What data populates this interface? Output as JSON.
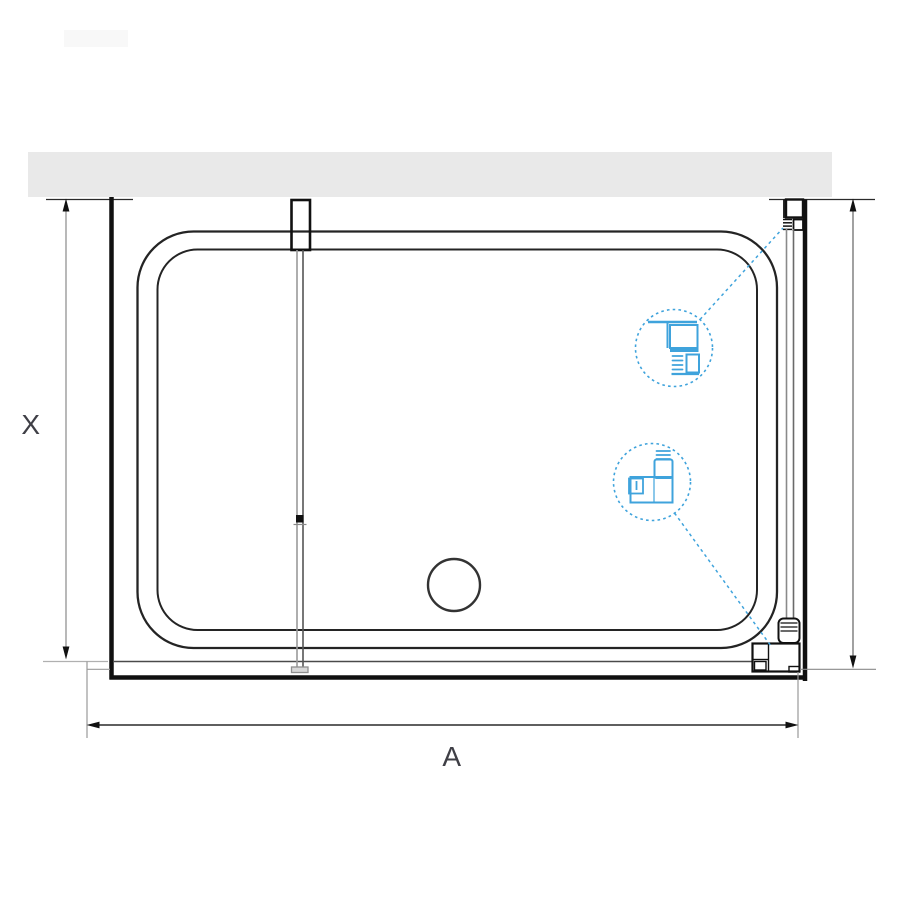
{
  "diagram": {
    "dimension_labels": {
      "vertical": "X",
      "horizontal": "A"
    },
    "colors": {
      "background": "#ffffff",
      "wall_fill": "#e9e9e9",
      "outline": "#1a1a1a",
      "tray_line": "#242424",
      "dimension_line": "#8a8a8a",
      "extension_line": "#a8a8a8",
      "accent_blue": "#3fa3dc",
      "label_text": "#3f3f46"
    },
    "icons": {
      "upper_callout": "wall-profile-section-icon",
      "lower_callout": "floor-profile-section-icon"
    }
  }
}
